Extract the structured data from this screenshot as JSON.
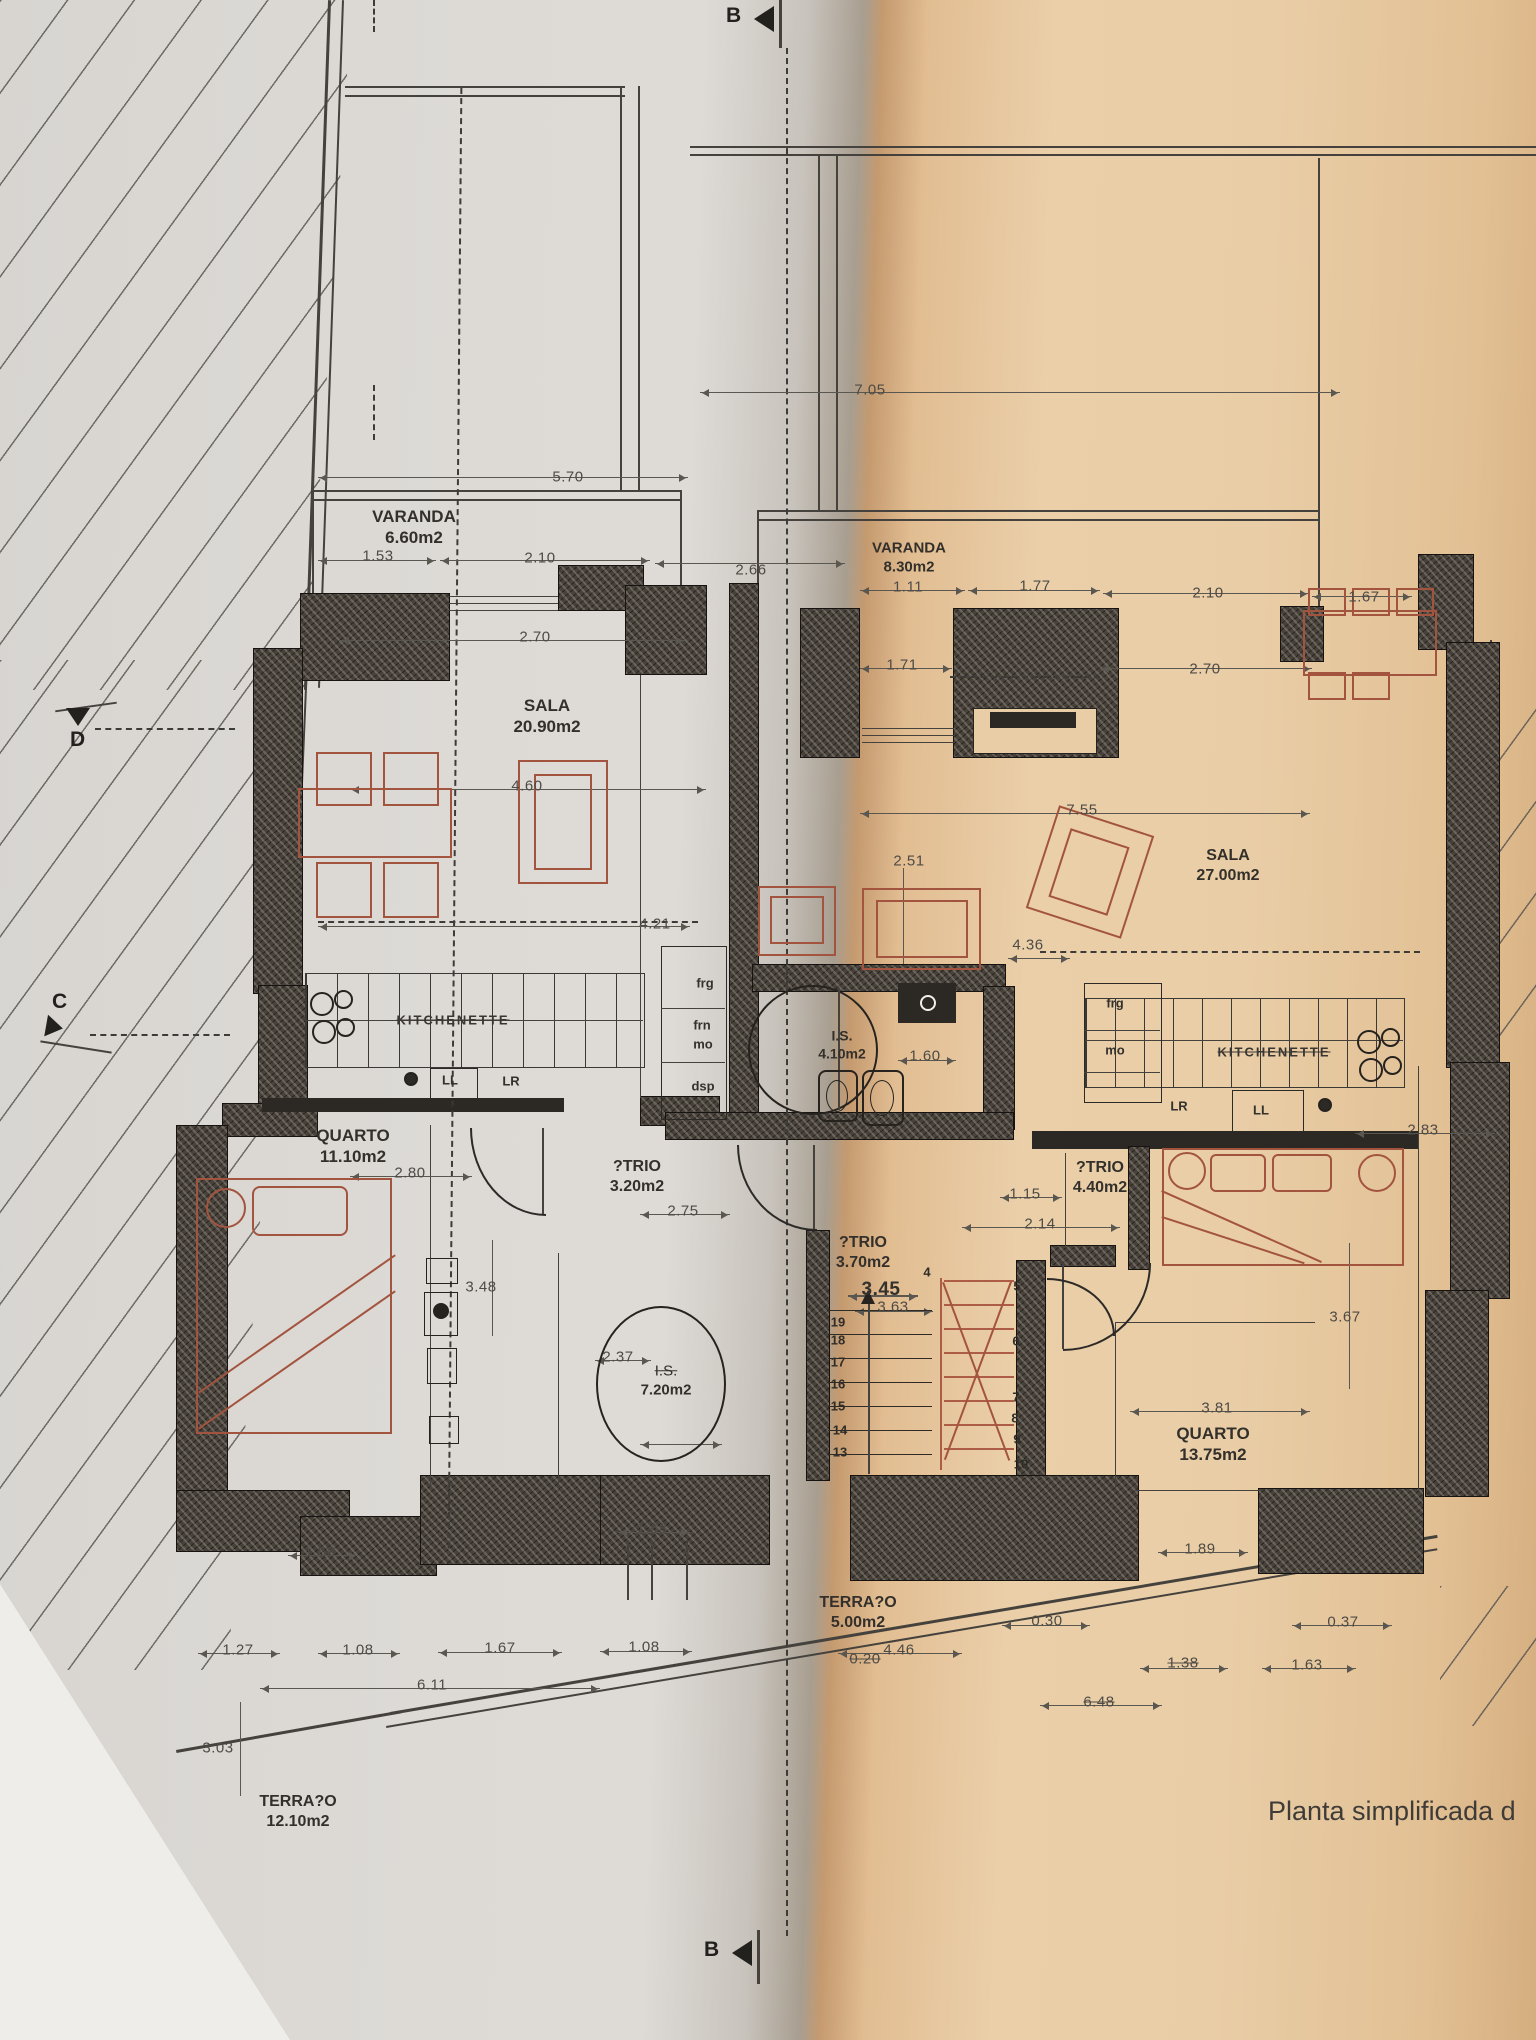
{
  "caption": "Planta simplificada d",
  "markers": {
    "b_top": "B",
    "b_bottom": "B",
    "c": "C",
    "d": "D"
  },
  "rooms": [
    {
      "name": "VARANDA",
      "area": "6.60m2",
      "x": 414,
      "y": 527,
      "s": 17
    },
    {
      "name": "VARANDA",
      "area": "8.30m2",
      "x": 909,
      "y": 558,
      "s": 15
    },
    {
      "name": "SALA",
      "area": "20.90m2",
      "x": 547,
      "y": 716,
      "s": 17
    },
    {
      "name": "SALA",
      "area": "27.00m2",
      "x": 1228,
      "y": 866,
      "s": 16
    },
    {
      "name": "QUARTO",
      "area": "11.10m2",
      "x": 353,
      "y": 1146,
      "s": 17
    },
    {
      "name": "QUARTO",
      "area": "13.75m2",
      "x": 1213,
      "y": 1444,
      "s": 17
    },
    {
      "name": "?TRIO",
      "area": "3.20m2",
      "x": 637,
      "y": 1177,
      "s": 16
    },
    {
      "name": "?TRIO",
      "area": "4.40m2",
      "x": 1100,
      "y": 1178,
      "s": 16
    },
    {
      "name": "?TRIO",
      "area": "3.70m2",
      "x": 863,
      "y": 1253,
      "s": 16
    },
    {
      "name": "I.S.",
      "area": "4.10m2",
      "x": 842,
      "y": 1045,
      "s": 14
    },
    {
      "name": "I.S.",
      "area": "7.20m2",
      "x": 666,
      "y": 1381,
      "s": 15,
      "strike_name": true
    },
    {
      "name": "TERRA?O",
      "area": "5.00m2",
      "x": 858,
      "y": 1613,
      "s": 16
    },
    {
      "name": "TERRA?O",
      "area": "12.10m2",
      "x": 298,
      "y": 1812,
      "s": 16
    }
  ],
  "kitchen_labels": [
    {
      "t": "KITCHENETTE",
      "x": 453,
      "y": 1020
    },
    {
      "t": "KITCHENETTE",
      "x": 1274,
      "y": 1052
    }
  ],
  "appliances": [
    {
      "t": "frg",
      "x": 705,
      "y": 983
    },
    {
      "t": "frn",
      "x": 702,
      "y": 1025
    },
    {
      "t": "mo",
      "x": 703,
      "y": 1044
    },
    {
      "t": "dsp",
      "x": 703,
      "y": 1086
    },
    {
      "t": "LL",
      "x": 450,
      "y": 1080
    },
    {
      "t": "LR",
      "x": 511,
      "y": 1081
    },
    {
      "t": "frg",
      "x": 1115,
      "y": 1003
    },
    {
      "t": "mo",
      "x": 1115,
      "y": 1050
    },
    {
      "t": "LR",
      "x": 1179,
      "y": 1106
    },
    {
      "t": "LL",
      "x": 1261,
      "y": 1110
    }
  ],
  "dims": [
    {
      "t": "5.70",
      "x": 568,
      "y": 477
    },
    {
      "t": "1.53",
      "x": 378,
      "y": 556
    },
    {
      "t": "2.10",
      "x": 540,
      "y": 558
    },
    {
      "t": "2.66",
      "x": 751,
      "y": 570
    },
    {
      "t": "2.70",
      "x": 535,
      "y": 637
    },
    {
      "t": "7.05",
      "x": 870,
      "y": 390
    },
    {
      "t": "1.11",
      "x": 908,
      "y": 587
    },
    {
      "t": "1.77",
      "x": 1035,
      "y": 586
    },
    {
      "t": "2.10",
      "x": 1208,
      "y": 593
    },
    {
      "t": "1.67",
      "x": 1364,
      "y": 597
    },
    {
      "t": "1.71",
      "x": 902,
      "y": 665
    },
    {
      "t": "2.70",
      "x": 1205,
      "y": 669
    },
    {
      "t": "2.51",
      "x": 909,
      "y": 861
    },
    {
      "t": "7.55",
      "x": 1082,
      "y": 810
    },
    {
      "t": "4.60",
      "x": 527,
      "y": 786
    },
    {
      "t": "4.21",
      "x": 655,
      "y": 924
    },
    {
      "t": "4.36",
      "x": 1028,
      "y": 945
    },
    {
      "t": "1.60",
      "x": 925,
      "y": 1056
    },
    {
      "t": "2.80",
      "x": 410,
      "y": 1173
    },
    {
      "t": "2.75",
      "x": 683,
      "y": 1211
    },
    {
      "t": "1.15",
      "x": 1025,
      "y": 1194
    },
    {
      "t": "2.14",
      "x": 1040,
      "y": 1224
    },
    {
      "t": "2.83",
      "x": 1423,
      "y": 1130
    },
    {
      "t": "3.67",
      "x": 1345,
      "y": 1317
    },
    {
      "t": "3.48",
      "x": 481,
      "y": 1287
    },
    {
      "t": "2.37",
      "x": 618,
      "y": 1357
    },
    {
      "t": "3.45",
      "x": 881,
      "y": 1290,
      "b": true
    },
    {
      "t": "3.63",
      "x": 893,
      "y": 1307
    },
    {
      "t": "3.81",
      "x": 1217,
      "y": 1408
    },
    {
      "t": "1.89",
      "x": 1200,
      "y": 1549
    },
    {
      "t": "1.68",
      "x": 320,
      "y": 1552
    },
    {
      "t": "1.68",
      "x": 652,
      "y": 1529
    },
    {
      "t": "1.27",
      "x": 238,
      "y": 1650
    },
    {
      "t": "1.08",
      "x": 358,
      "y": 1650
    },
    {
      "t": "1.67",
      "x": 500,
      "y": 1648
    },
    {
      "t": "1.08",
      "x": 644,
      "y": 1647
    },
    {
      "t": "6.11",
      "x": 432,
      "y": 1685
    },
    {
      "t": "3.03",
      "x": 218,
      "y": 1748
    },
    {
      "t": "0.20",
      "x": 865,
      "y": 1659,
      "k": true
    },
    {
      "t": "4.46",
      "x": 899,
      "y": 1650
    },
    {
      "t": "0.30",
      "x": 1047,
      "y": 1621
    },
    {
      "t": "0.37",
      "x": 1343,
      "y": 1622
    },
    {
      "t": "1.38",
      "x": 1183,
      "y": 1663,
      "k": true
    },
    {
      "t": "1.63",
      "x": 1307,
      "y": 1665
    },
    {
      "t": "6.48",
      "x": 1099,
      "y": 1702,
      "k": true
    }
  ],
  "stairs": {
    "left": [
      {
        "t": "19",
        "x": 838,
        "y": 1322
      },
      {
        "t": "18",
        "x": 838,
        "y": 1340
      },
      {
        "t": "17",
        "x": 838,
        "y": 1362
      },
      {
        "t": "16",
        "x": 838,
        "y": 1384
      },
      {
        "t": "15",
        "x": 838,
        "y": 1406
      },
      {
        "t": "14",
        "x": 840,
        "y": 1430
      },
      {
        "t": "13",
        "x": 840,
        "y": 1452
      }
    ],
    "right": [
      {
        "t": "4",
        "x": 927,
        "y": 1272
      },
      {
        "t": "5",
        "x": 1017,
        "y": 1286
      },
      {
        "t": "6",
        "x": 1016,
        "y": 1341
      },
      {
        "t": "7",
        "x": 1016,
        "y": 1397
      },
      {
        "t": "8",
        "x": 1015,
        "y": 1418
      },
      {
        "t": "9",
        "x": 1017,
        "y": 1439
      },
      {
        "t": "10",
        "x": 1021,
        "y": 1464
      }
    ]
  }
}
